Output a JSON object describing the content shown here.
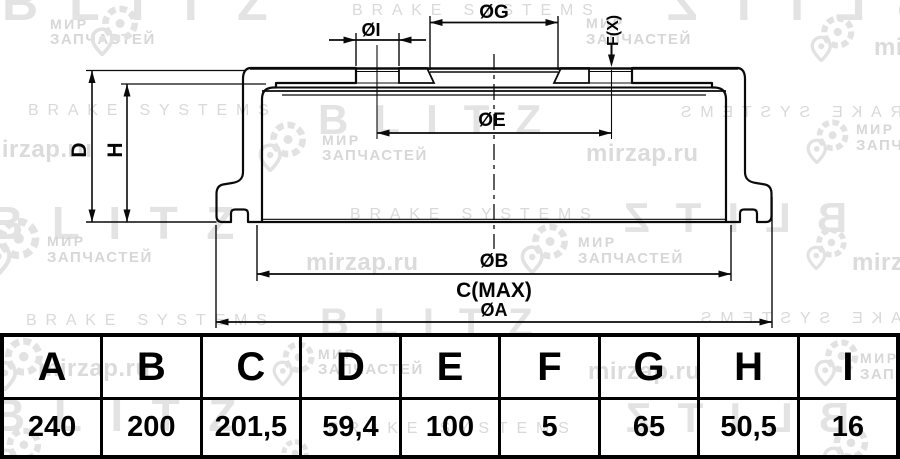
{
  "watermarks": {
    "blitz": "BLITZ",
    "brake_systems": "BRAKE SYSTEMS",
    "mir": "МИР",
    "zapchastey": "ЗАПЧАСТЕЙ",
    "site": "mirzap.ru"
  },
  "drawing": {
    "dim_labels": {
      "G": "ØG",
      "I": "ØI",
      "F": "F(X)",
      "E": "ØE",
      "D": "D",
      "H": "H",
      "B": "ØB",
      "C": "C(MAX)",
      "A": "ØA"
    }
  },
  "table": {
    "columns": [
      {
        "header": "A",
        "value": "240"
      },
      {
        "header": "B",
        "value": "200"
      },
      {
        "header": "C",
        "value": "201,5"
      },
      {
        "header": "D",
        "value": "59,4"
      },
      {
        "header": "E",
        "value": "100"
      },
      {
        "header": "F",
        "value": "5"
      },
      {
        "header": "G",
        "value": "65"
      },
      {
        "header": "H",
        "value": "50,5"
      },
      {
        "header": "I",
        "value": "16"
      }
    ]
  }
}
